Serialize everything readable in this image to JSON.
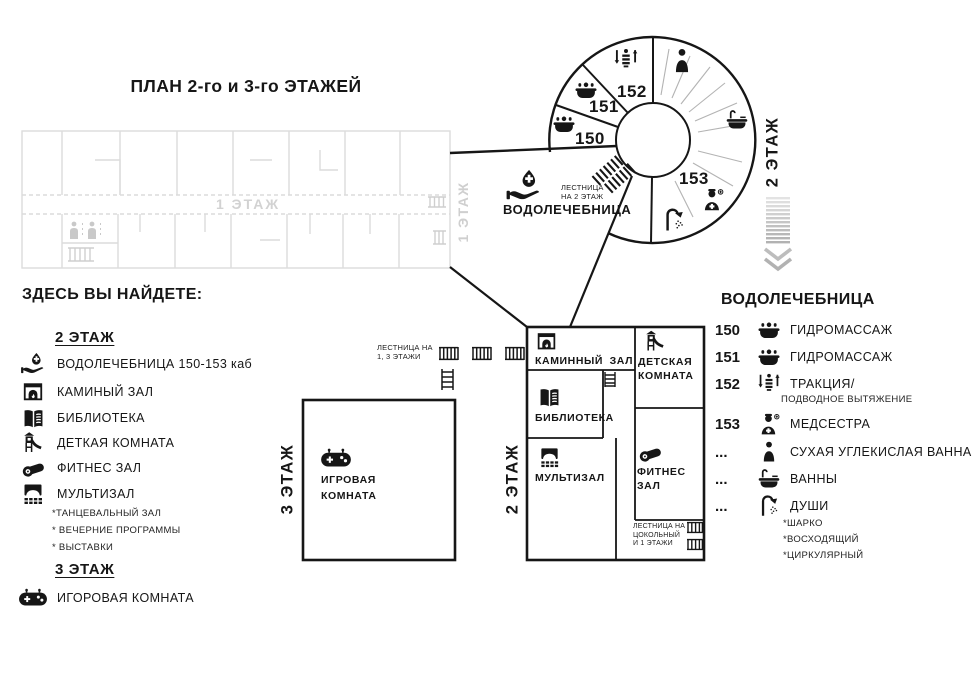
{
  "title": "ПЛАН 2-го и 3-го ЭТАЖЕЙ",
  "plan1": {
    "corridor_label": "1 ЭТАЖ",
    "side_label": "1 ЭТАЖ"
  },
  "circle": {
    "side_label": "2 ЭТАЖ",
    "n150": "150",
    "n151": "151",
    "n152": "152",
    "n153": "153"
  },
  "funnel": {
    "note1": "ЛЕСТНИЦА",
    "note2": "НА 2 ЭТАЖ",
    "label": "ВОДОЛЕЧЕБНИЦА"
  },
  "stairs13": {
    "l1": "ЛЕСТНИЦА НА",
    "l2": "1, 3 ЭТАЖИ"
  },
  "box3": {
    "side_label": "3 ЭТАЖ",
    "room_l1": "ИГРОВАЯ",
    "room_l2": "КОМНАТА"
  },
  "box2": {
    "side_label": "2 ЭТАЖ",
    "fireplace": "КАМИННЫЙ  ЗАЛ",
    "kids_l1": "ДЕТСКАЯ",
    "kids_l2": "КОМНАТА",
    "library": "БИБЛИОТЕКА",
    "multihall": "МУЛЬТИЗАЛ",
    "fitness_l1": "ФИТНЕС",
    "fitness_l2": "ЗАЛ",
    "stairs_l1": "ЛЕСТНИЦА НА",
    "stairs_l2": "ЦОКОЛЬНЫЙ",
    "stairs_l3": "И 1 ЭТАЖИ"
  },
  "legendLeft": {
    "header": "ЗДЕСЬ ВЫ НАЙДЕТЕ:",
    "floor2": "2 ЭТАЖ",
    "floor3": "3 ЭТАЖ",
    "items": [
      {
        "icon": "water-hand-icon",
        "label": "ВОДОЛЕЧЕБНИЦА 150-153 каб"
      },
      {
        "icon": "fireplace-icon",
        "label": "КАМИНЫЙ ЗАЛ"
      },
      {
        "icon": "book-icon",
        "label": "БИБЛИОТЕКА"
      },
      {
        "icon": "slide-icon",
        "label": "ДЕТКАЯ КОМНАТА"
      },
      {
        "icon": "mat-icon",
        "label": "ФИТНЕС ЗАЛ"
      },
      {
        "icon": "screen-icon",
        "label": "МУЛЬТИЗАЛ"
      }
    ],
    "multiNotes": [
      "*ТАНЦЕВАЛЬНЫЙ ЗАЛ",
      "* ВЕЧЕРНИЕ ПРОГРАММЫ",
      "* ВЫСТАВКИ"
    ],
    "floor3Item": "ИГОРОВАЯ КОМНАТА"
  },
  "legendRight": {
    "header": "ВОДОЛЕЧЕБНИЦА",
    "items": [
      {
        "num": "150",
        "icon": "hydro-tub-icon",
        "label": "ГИДРОМАССАЖ"
      },
      {
        "num": "151",
        "icon": "hydro-tub-icon",
        "label": "ГИДРОМАССАЖ"
      },
      {
        "num": "152",
        "icon": "traction-icon",
        "label": "ТРАКЦИЯ/",
        "sub": "ПОДВОДНОЕ ВЫТЯЖЕНИЕ"
      },
      {
        "num": "153",
        "icon": "nurse-icon",
        "label": "МЕДСЕСТРА"
      },
      {
        "num": "...",
        "icon": "person-icon",
        "label": "СУХАЯ УГЛЕКИСЛАЯ ВАННА"
      },
      {
        "num": "...",
        "icon": "bath-icon",
        "label": "ВАННЫ"
      },
      {
        "num": "...",
        "icon": "shower-icon",
        "label": "ДУШИ"
      }
    ],
    "showerNotes": [
      "*ШАРКО",
      "*ВОСХОДЯЩИЙ",
      "*ЦИРКУЛЯРНЫЙ"
    ]
  },
  "colors": {
    "ink": "#161616",
    "faded": "#d9d9d9",
    "gray": "#b5b5b5"
  }
}
